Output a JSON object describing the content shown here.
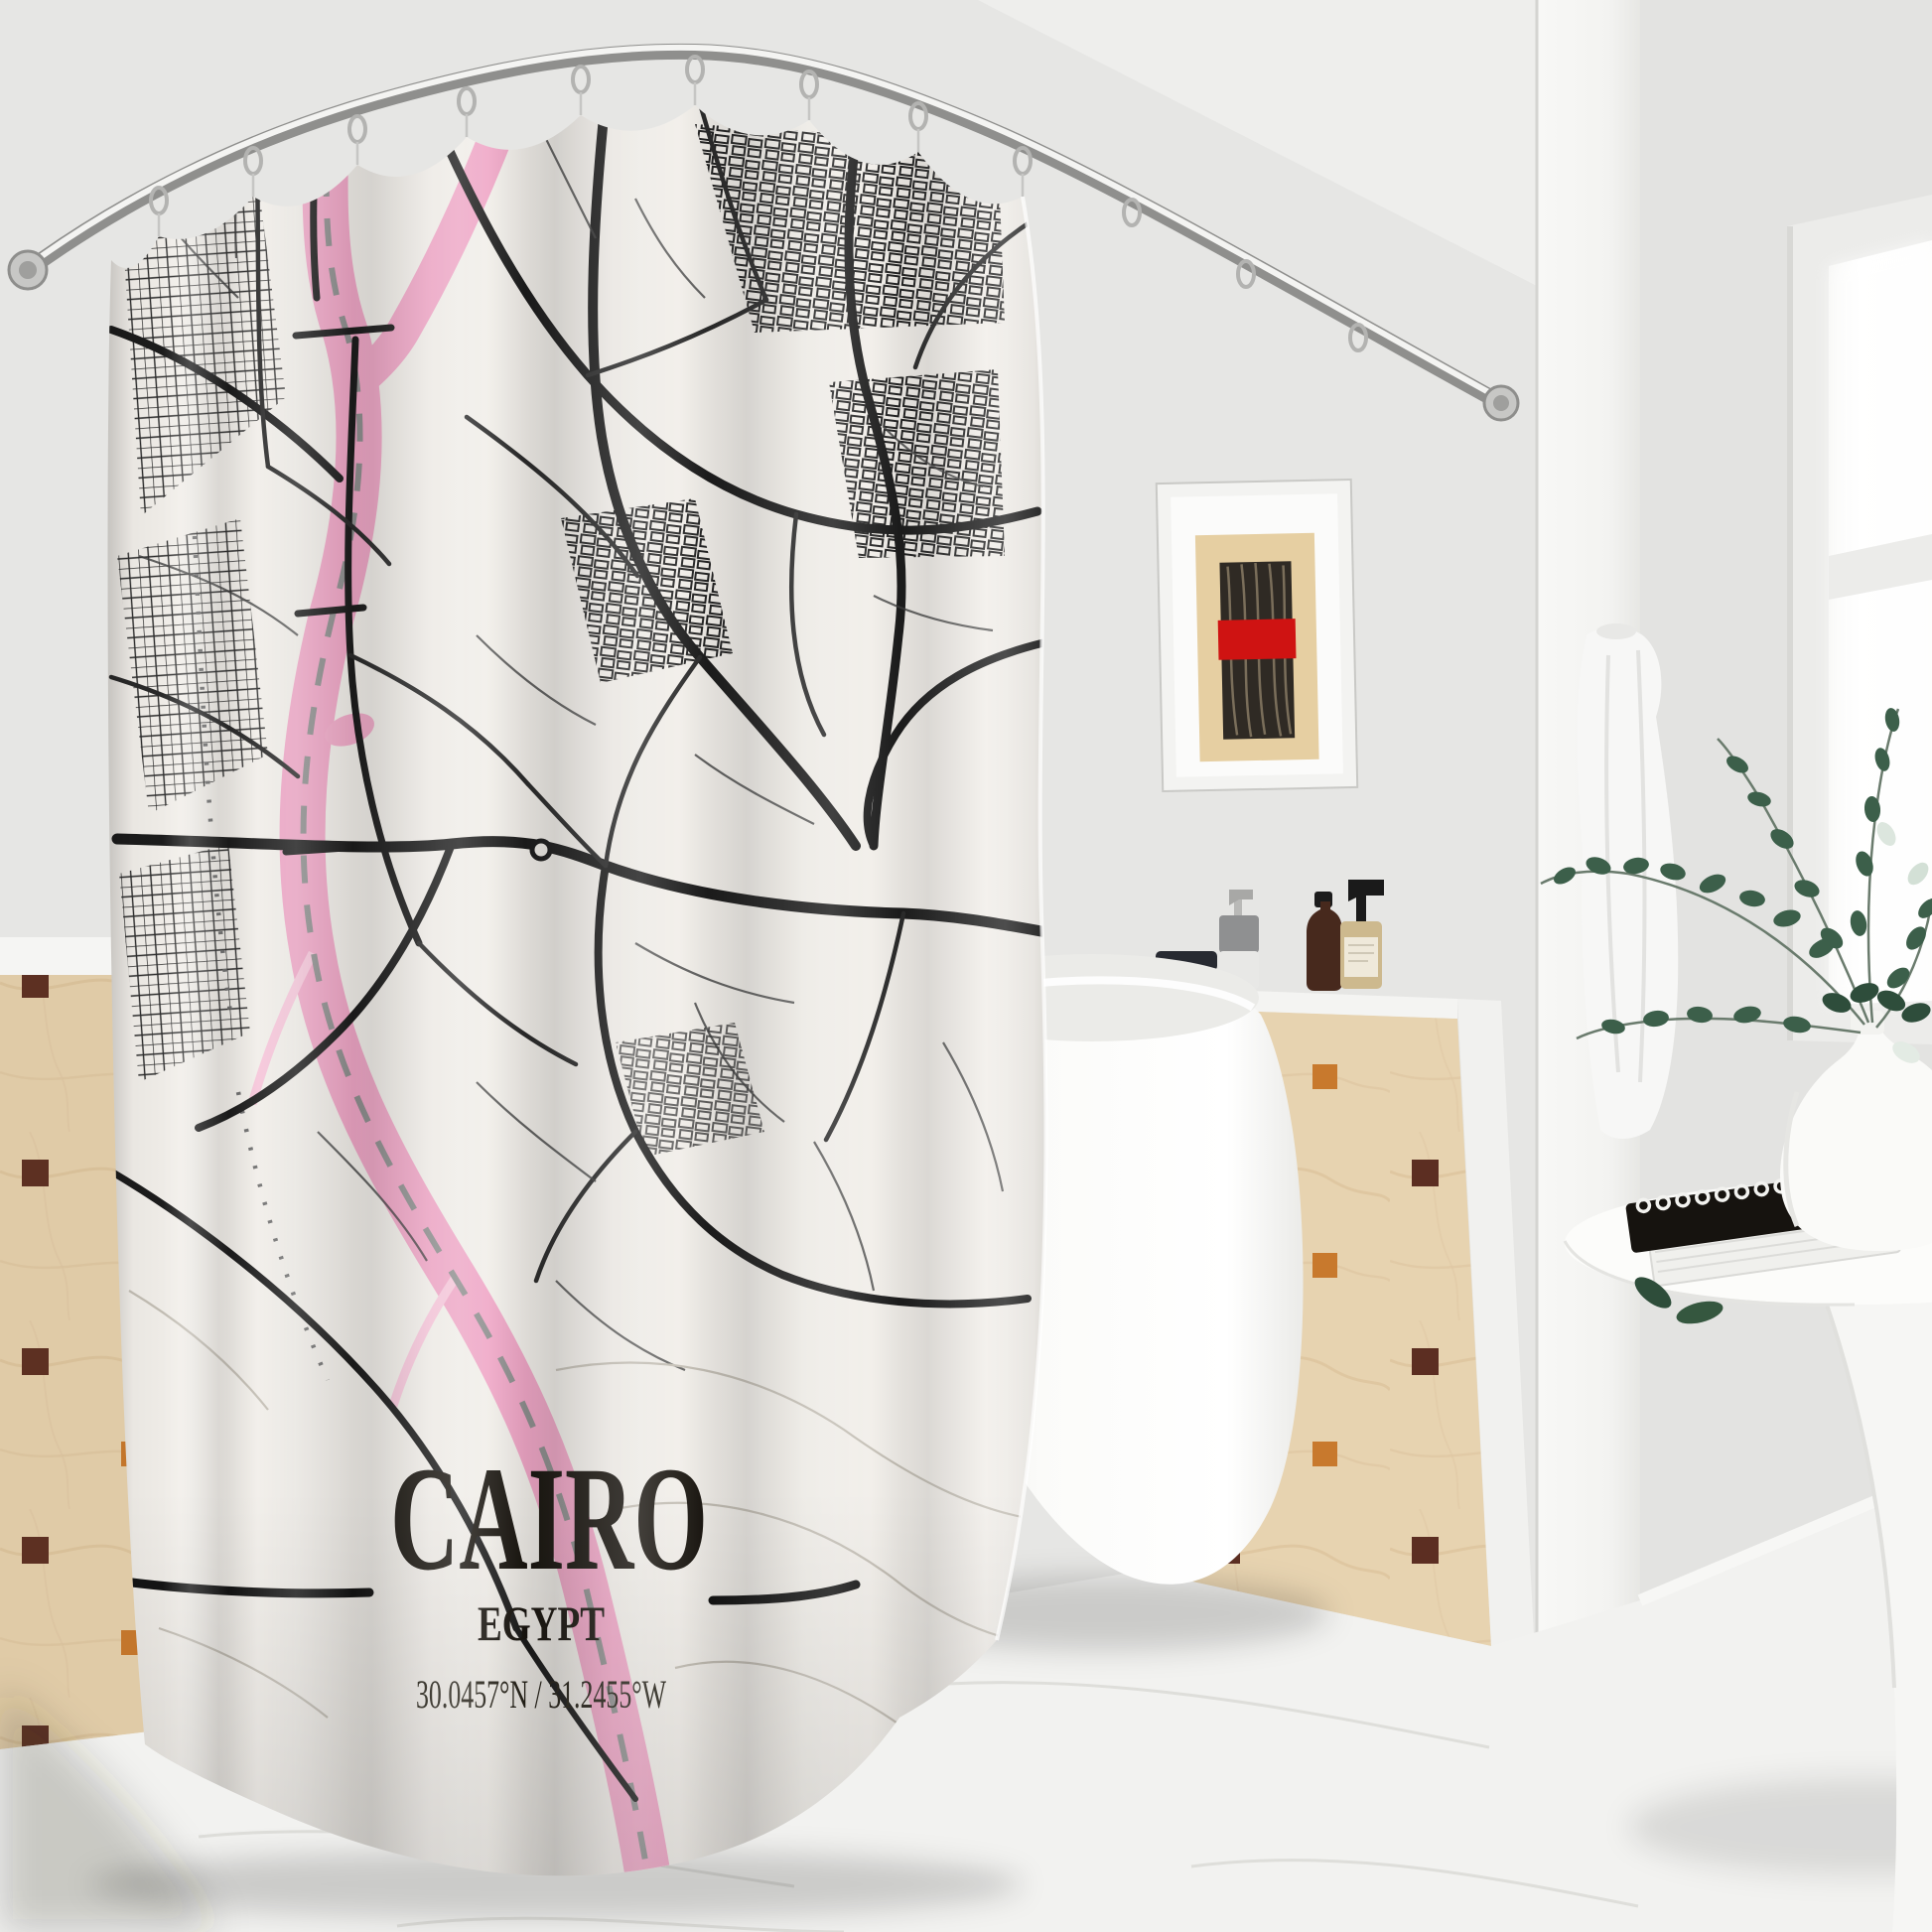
{
  "curtain_print": {
    "title": "CAIRO",
    "subtitle": "EGYPT",
    "coordinates": "30.0457°N / 31.2455°W",
    "colors": {
      "background": "#f1eee9",
      "roads": "#1c1c1c",
      "river": "#efa6c6",
      "river_light": "#f6c6da"
    }
  },
  "room_palette": {
    "wall": "#e6e6e4",
    "ceiling": "#eeeeec",
    "tile": "#e7d3b0",
    "tile_accent_dark": "#5c2e22",
    "tile_accent_orange": "#c8792d",
    "art_red_band": "#cf1312",
    "floor": "#f2f2f0",
    "metal": "#b0b0ae"
  }
}
